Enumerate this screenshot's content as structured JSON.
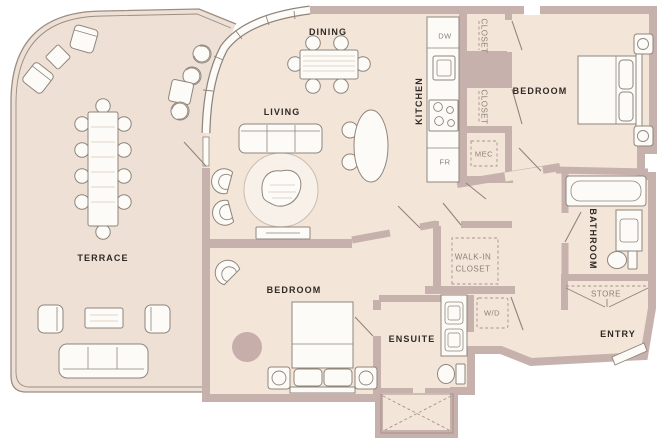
{
  "plan": {
    "title": "Two-bedroom residence floor plan with terrace",
    "unit_labels": {
      "terrace": "TERRACE",
      "dining": "DINING",
      "living": "LIVING",
      "kitchen": "KITCHEN",
      "bedroom_upper": "BEDROOM",
      "bedroom_lower": "BEDROOM",
      "bathroom": "BATHROOM",
      "ensuite": "ENSUITE",
      "entry": "ENTRY",
      "walk_in_closet": "WALK-IN CLOSET",
      "store": "STORE",
      "closet_upper": "CLOSET",
      "closet_lower": "CLOSET",
      "mec": "MEC",
      "washer_dryer": "W/D",
      "dishwasher": "DW",
      "fridge": "FR"
    },
    "colors": {
      "background": "#ffffff",
      "interior_floor": "#f4e5d9",
      "terrace_floor": "#eee0d4",
      "wall": "#c7b1ac",
      "rug_accent": "#c8aeab",
      "living_rug": "#f8f1e9",
      "furniture_fill": "#fdfbf8",
      "furniture_outline": "#8f857b",
      "label_dark": "#2f2a26",
      "label_muted": "#8c8177"
    }
  }
}
